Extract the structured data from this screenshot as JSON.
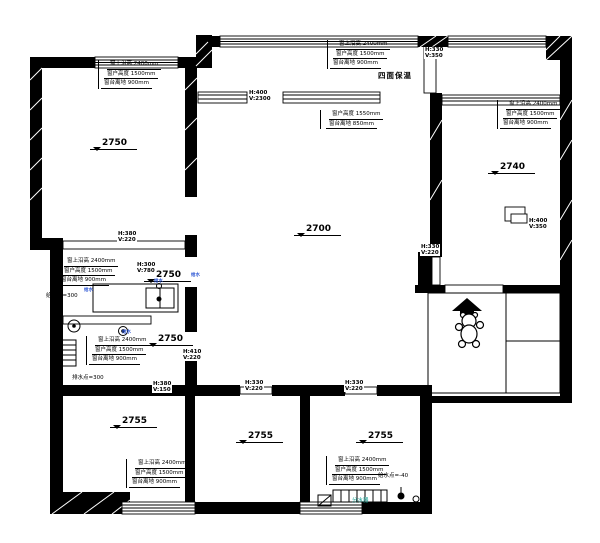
{
  "colors": {
    "line": "#000000",
    "water_blue": "#2b55d4",
    "manifold_teal": "#0f9b8e",
    "paper": "#ffffff"
  },
  "insulation_note": "四面保温",
  "levels": [
    "2750",
    "2700",
    "2740",
    "2750",
    "2750",
    "2755",
    "2755",
    "2755"
  ],
  "beams": [
    {
      "h": "H:330",
      "v": "V:350"
    },
    {
      "h": "H:400",
      "v": "V:2300"
    },
    {
      "h": "H:380",
      "v": "V:220"
    },
    {
      "h": "H:330",
      "v": "V:220"
    },
    {
      "h": "H:300",
      "v": "V:780"
    },
    {
      "h": "H:410",
      "v": "V:220"
    },
    {
      "h": "H:380",
      "v": "V:150"
    },
    {
      "h": "H:330",
      "v": "V:220"
    },
    {
      "h": "H:330",
      "v": "V:220"
    },
    {
      "h": "H:400",
      "v": "V:350"
    }
  ],
  "window_notes": [
    {
      "l1": "窗上沿高 2400mm",
      "l2": "窗户高度 1500mm",
      "l3": "窗台离地 900mm"
    },
    {
      "l1": "窗上沿高 2400mm",
      "l2": "窗户高度 1500mm",
      "l3": "窗台离地 900mm"
    },
    {
      "l1": "窗上沿高 2400mm",
      "l2": "窗户高度 1500mm",
      "l3": "窗台离地 900mm"
    },
    {
      "l1": "窗上沿高 2400mm",
      "l2": "窗户高度 1500mm",
      "l3": "窗台离地 900mm"
    },
    {
      "l1": "窗上沿高 2400mm",
      "l2": "窗户高度 1500mm",
      "l3": "窗台离地 900mm"
    },
    {
      "l1": "窗上沿高 2400mm",
      "l2": "窗户高度 1500mm",
      "l3": "窗台离地 900mm"
    },
    {
      "l1": "窗上沿高 2400mm",
      "l2": "窗户高度 1500mm",
      "l3": "窗台离地 900mm"
    }
  ],
  "beam_note": {
    "l1": "窗户高度 1550mm",
    "l2": "窗台离地 850mm"
  },
  "plumbing": {
    "supply_left": "给水点=300",
    "drain_left": "排水点=300",
    "supply_right": "给水点=-40",
    "manifold": "分水器",
    "point_mark": "给水"
  }
}
